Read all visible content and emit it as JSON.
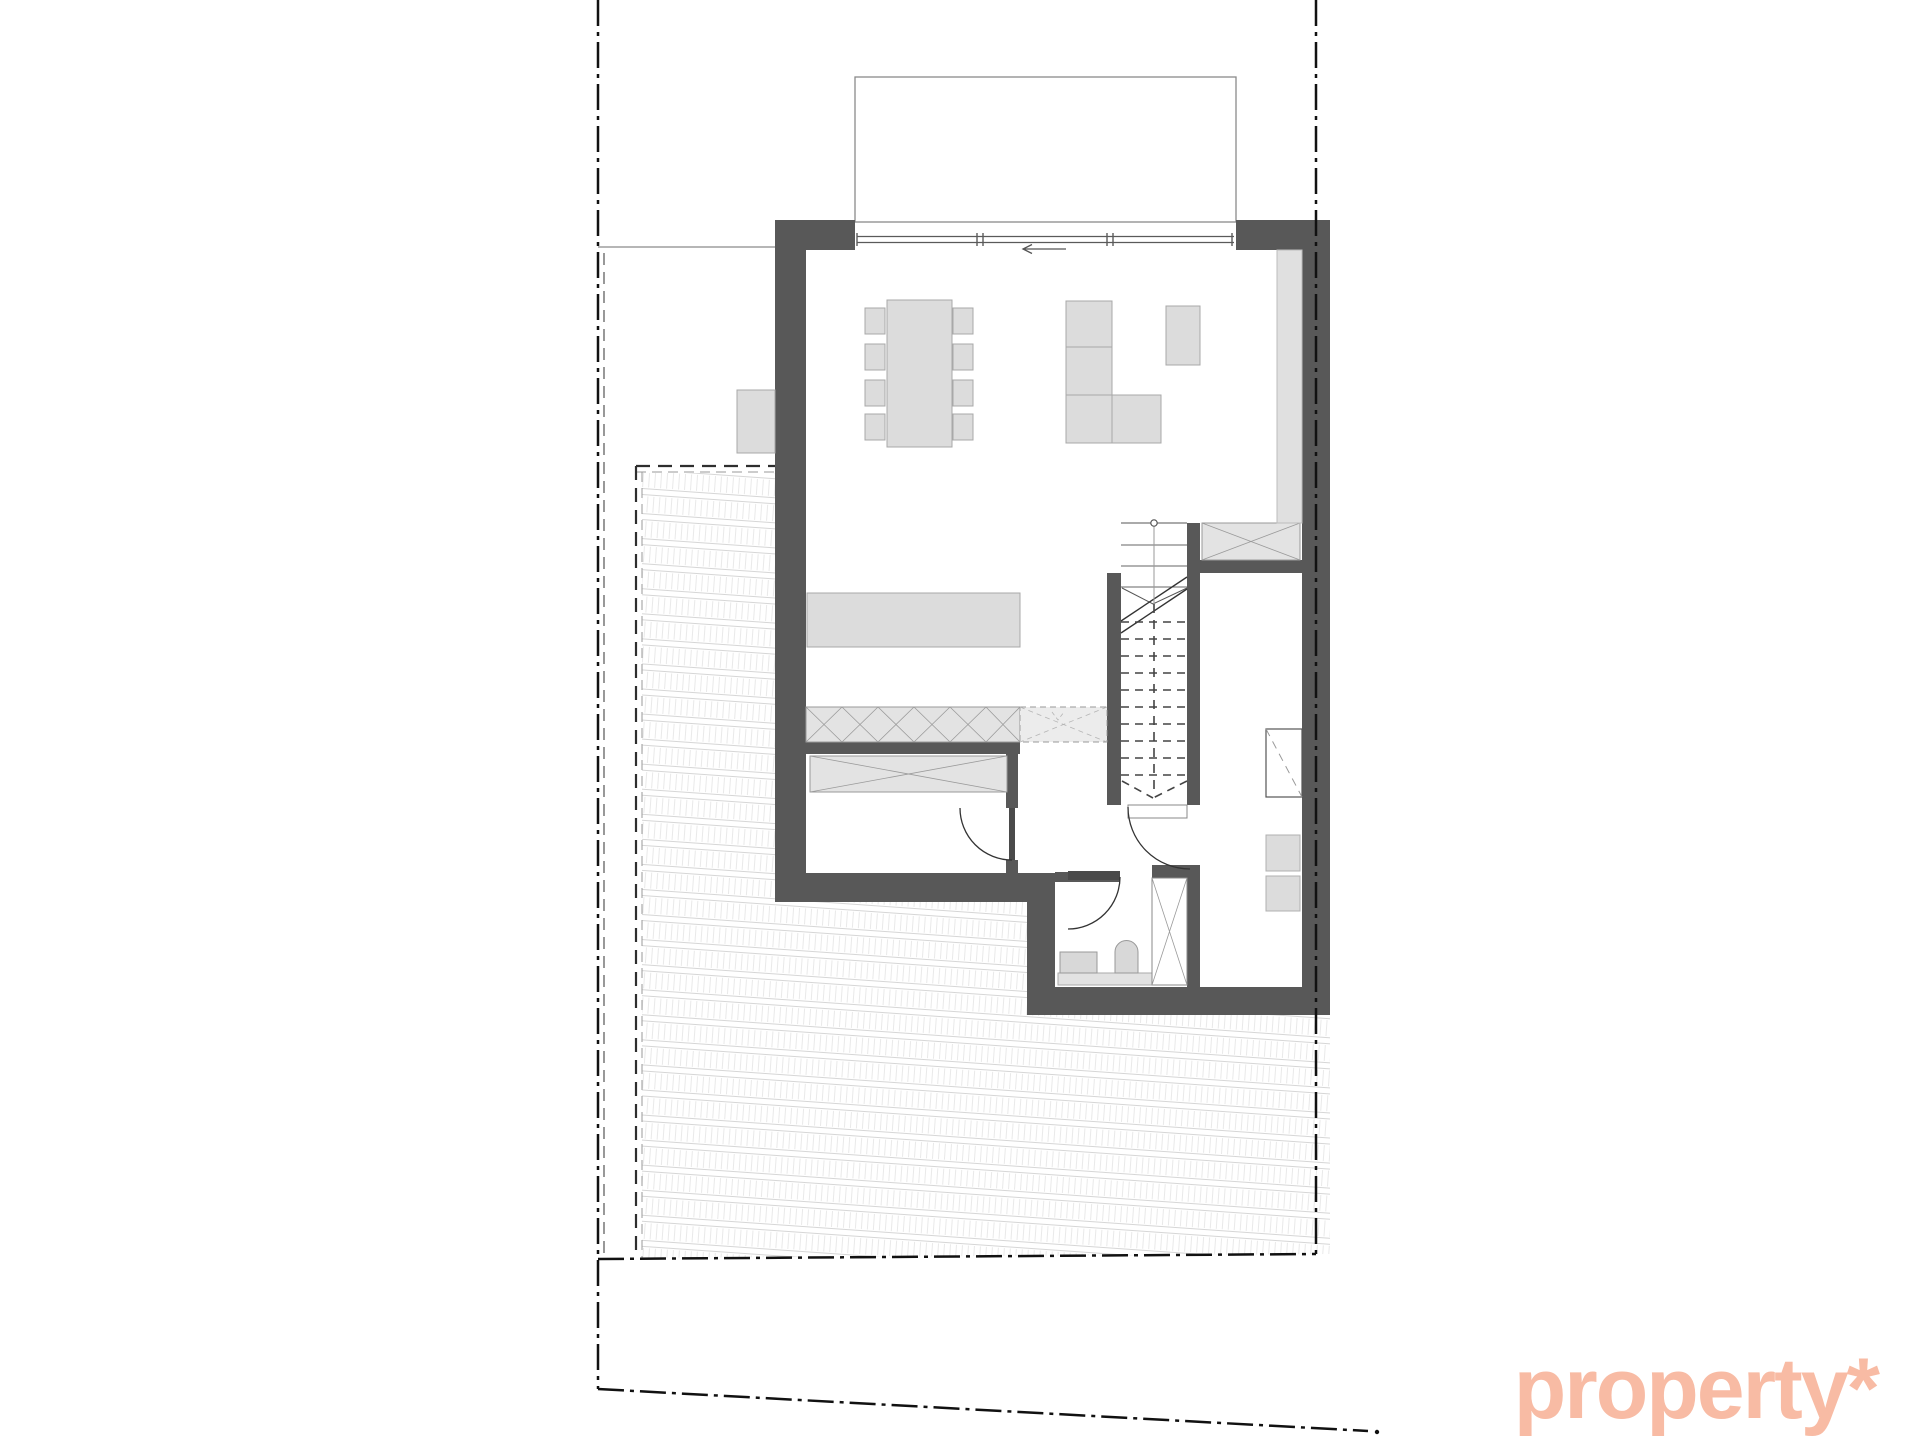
{
  "watermark": {
    "text": "property*"
  },
  "palette": {
    "logo": "#f8bba4",
    "wall": "#585858",
    "wall_dark": "#4a4a4a",
    "furniture_fill": "#dcdcdc",
    "furniture_light": "#e3e3e3",
    "furniture_border": "#a8a8a8",
    "outline": "#8a8a8a",
    "line_dark": "#333333",
    "boundary": "#111111",
    "hatch_line": "#d6d6d6",
    "hatch_tick": "#e9e9e9",
    "background": "#ffffff"
  }
}
